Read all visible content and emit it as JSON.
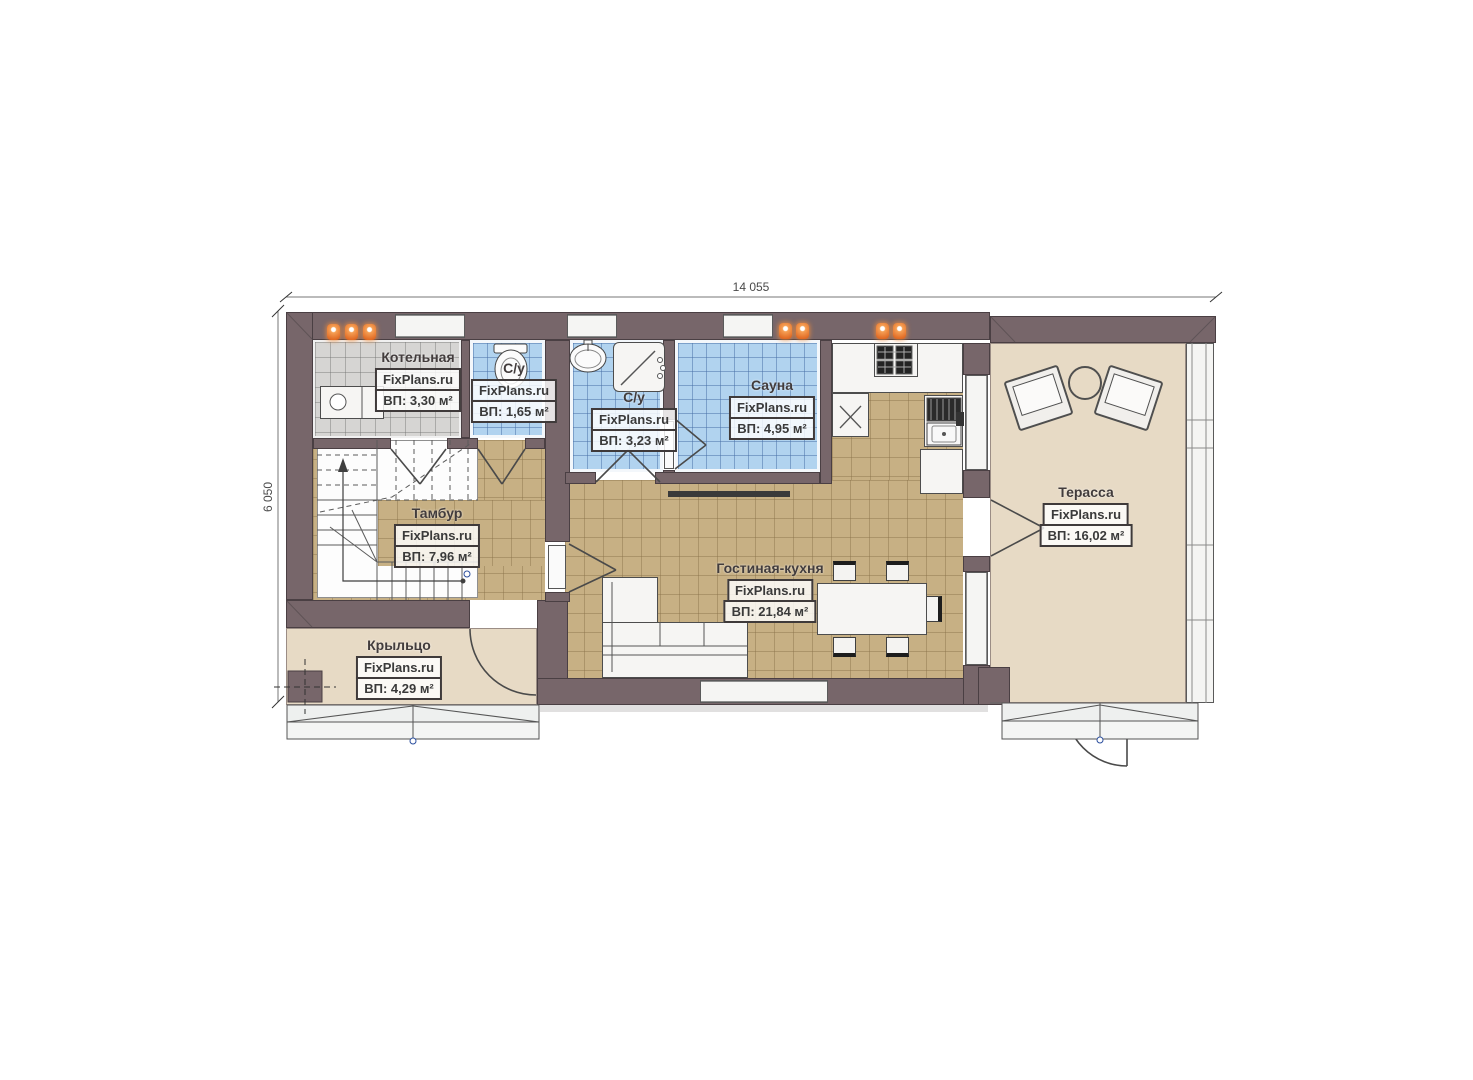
{
  "plan_title": "Floor plan",
  "dimensions": {
    "width": "14 055",
    "height": "6 050"
  },
  "watermark": "FixPlans.ru",
  "rooms": [
    {
      "id": "boiler",
      "name": "Котельная",
      "brand": "FixPlans.ru",
      "area": "ВП: 3,30 м²"
    },
    {
      "id": "wc-small",
      "name": "С/у",
      "brand": "FixPlans.ru",
      "area": "ВП: 1,65 м²"
    },
    {
      "id": "wc-shower",
      "name": "С/у",
      "brand": "FixPlans.ru",
      "area": "ВП: 3,23 м²"
    },
    {
      "id": "sauna",
      "name": "Сауна",
      "brand": "FixPlans.ru",
      "area": "ВП: 4,95 м²"
    },
    {
      "id": "vestibule",
      "name": "Тамбур",
      "brand": "FixPlans.ru",
      "area": "ВП: 7,96 м²"
    },
    {
      "id": "living-kitchen",
      "name": "Гостиная-кухня",
      "brand": "FixPlans.ru",
      "area": "ВП: 21,84 м²"
    },
    {
      "id": "terrace",
      "name": "Терасса",
      "brand": "FixPlans.ru",
      "area": "ВП: 16,02 м²"
    },
    {
      "id": "porch",
      "name": "Крыльцо",
      "brand": "FixPlans.ru",
      "area": "ВП: 4,29 м²"
    }
  ],
  "colors": {
    "wall": "#77666a",
    "tile_blue": "#b1d3ef",
    "tile_beige": "#c7b084",
    "tile_gray": "#d6d5d3",
    "plain_floor": "#e7dac5",
    "radiator": "#e06a24"
  }
}
